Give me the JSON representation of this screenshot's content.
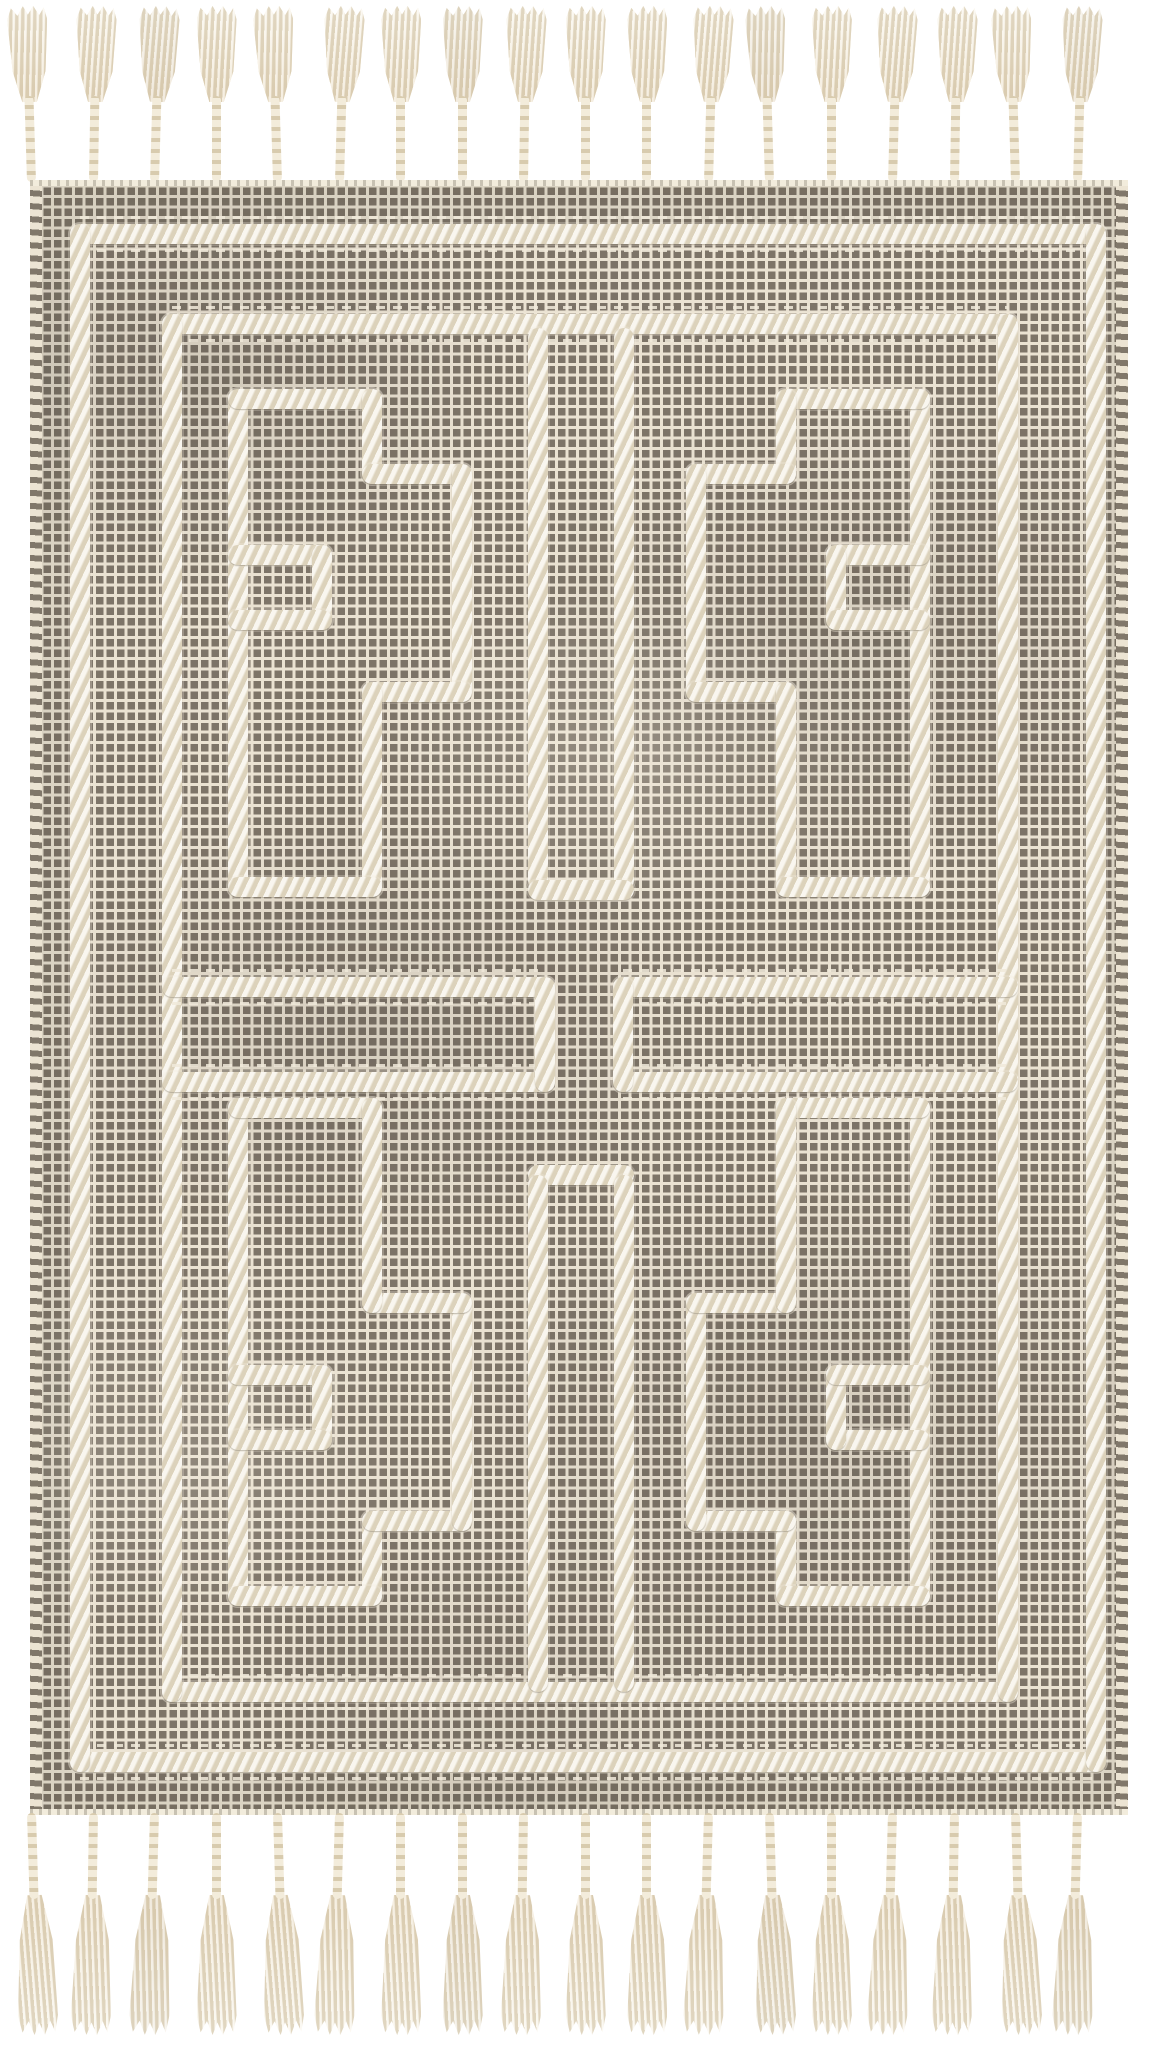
{
  "title": "Handwoven area rug product photo",
  "scene": {
    "background_color": "#ffffff",
    "description": "Flat-lay photo of a handwoven cream and taupe-gray area rug. A fine grid weave of dark taupe knots on a cream ground is overlaid with raised ivory braided lines forming an outer border frame, an inner panel frame, four mirrored Greek-key maze motifs arranged two by two, a narrow bar hanging from the top frame and rising from the bottom frame, and two horizontal bars across the middle. Braided ivory cords ending in flared tassels fringe the top and bottom edges, and the side edges are whip-stitched."
  },
  "palette": {
    "background": "#ffffff",
    "rug_base": "#eae2d2",
    "weave_dot": "#7d7468",
    "weave_dot_deep": "#5a5348",
    "braid_cream": "#f2ecdc",
    "braid_shade": "#c9bb9e",
    "tassel_cream": "#f3ecdb",
    "tassel_shade": "#d8cbae",
    "edge_stitch": "#80776a"
  },
  "rug": {
    "weave": "grid of dark taupe knots on cream ground",
    "border_frames": 2,
    "motif_style": "interlocking Greek-key meander blocks",
    "motif_count": 4,
    "motif_arrangement": "2x2 quadrants mirrored about both axes",
    "center_elements": [
      "narrow bar hanging from top panel frame",
      "narrow bar rising from bottom panel frame",
      "left horizontal mid bar",
      "right horizontal mid bar"
    ],
    "edge_finish": "whip-stitched sides with cream selvedge top and bottom"
  },
  "tassels": {
    "top_count": 18,
    "bottom_count": 18,
    "style": "braided cord with flared fringe head",
    "color": "#f3ecdb"
  }
}
